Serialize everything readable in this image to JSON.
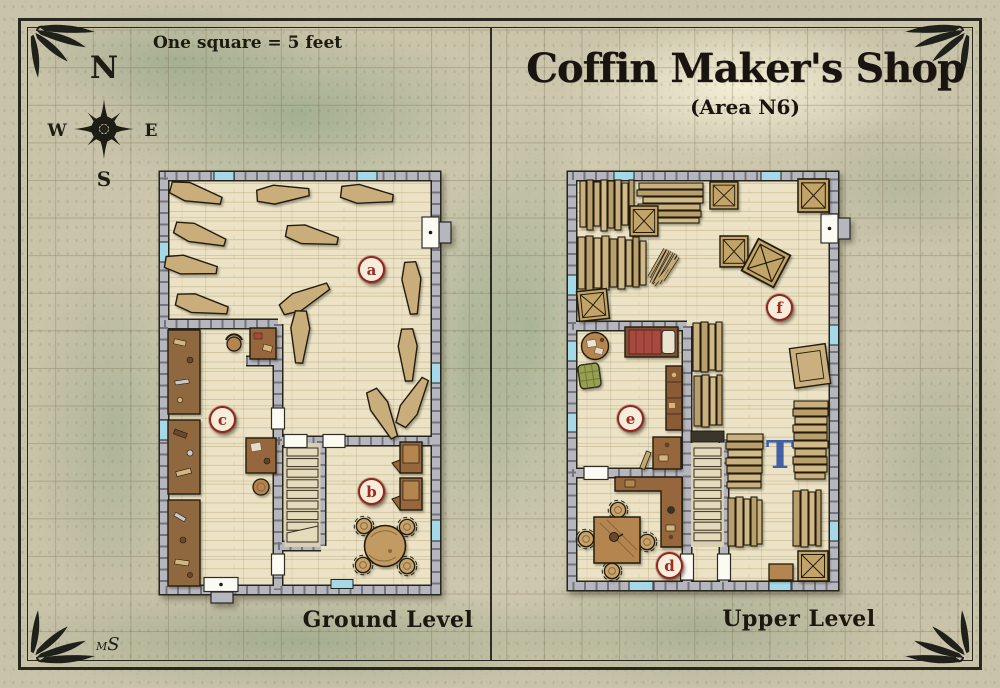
{
  "title": {
    "main": "Coffin Maker's Shop",
    "area": "(Area N6)"
  },
  "scale_note": "One square = 5 feet",
  "compass": {
    "n": "N",
    "e": "E",
    "s": "S",
    "w": "W"
  },
  "levels": {
    "ground": {
      "caption": "Ground Level",
      "rooms": {
        "a": "a",
        "b": "b",
        "c": "c"
      }
    },
    "upper": {
      "caption": "Upper Level",
      "rooms": {
        "d": "d",
        "e": "e",
        "f": "f"
      },
      "annotation": "T"
    }
  },
  "signature": "MS",
  "colors": {
    "label_red": "#9e2a22",
    "annotation_blue": "#2b4f9e",
    "ink": "#28281f",
    "parchment": "#c9c3a9",
    "wall_gray": "#b6b6be",
    "floor_wood": "#ece3c6",
    "furniture_wood": "#96663d",
    "coffin_wood": "#c9ae7c",
    "window_blue": "#a6d9e8"
  }
}
